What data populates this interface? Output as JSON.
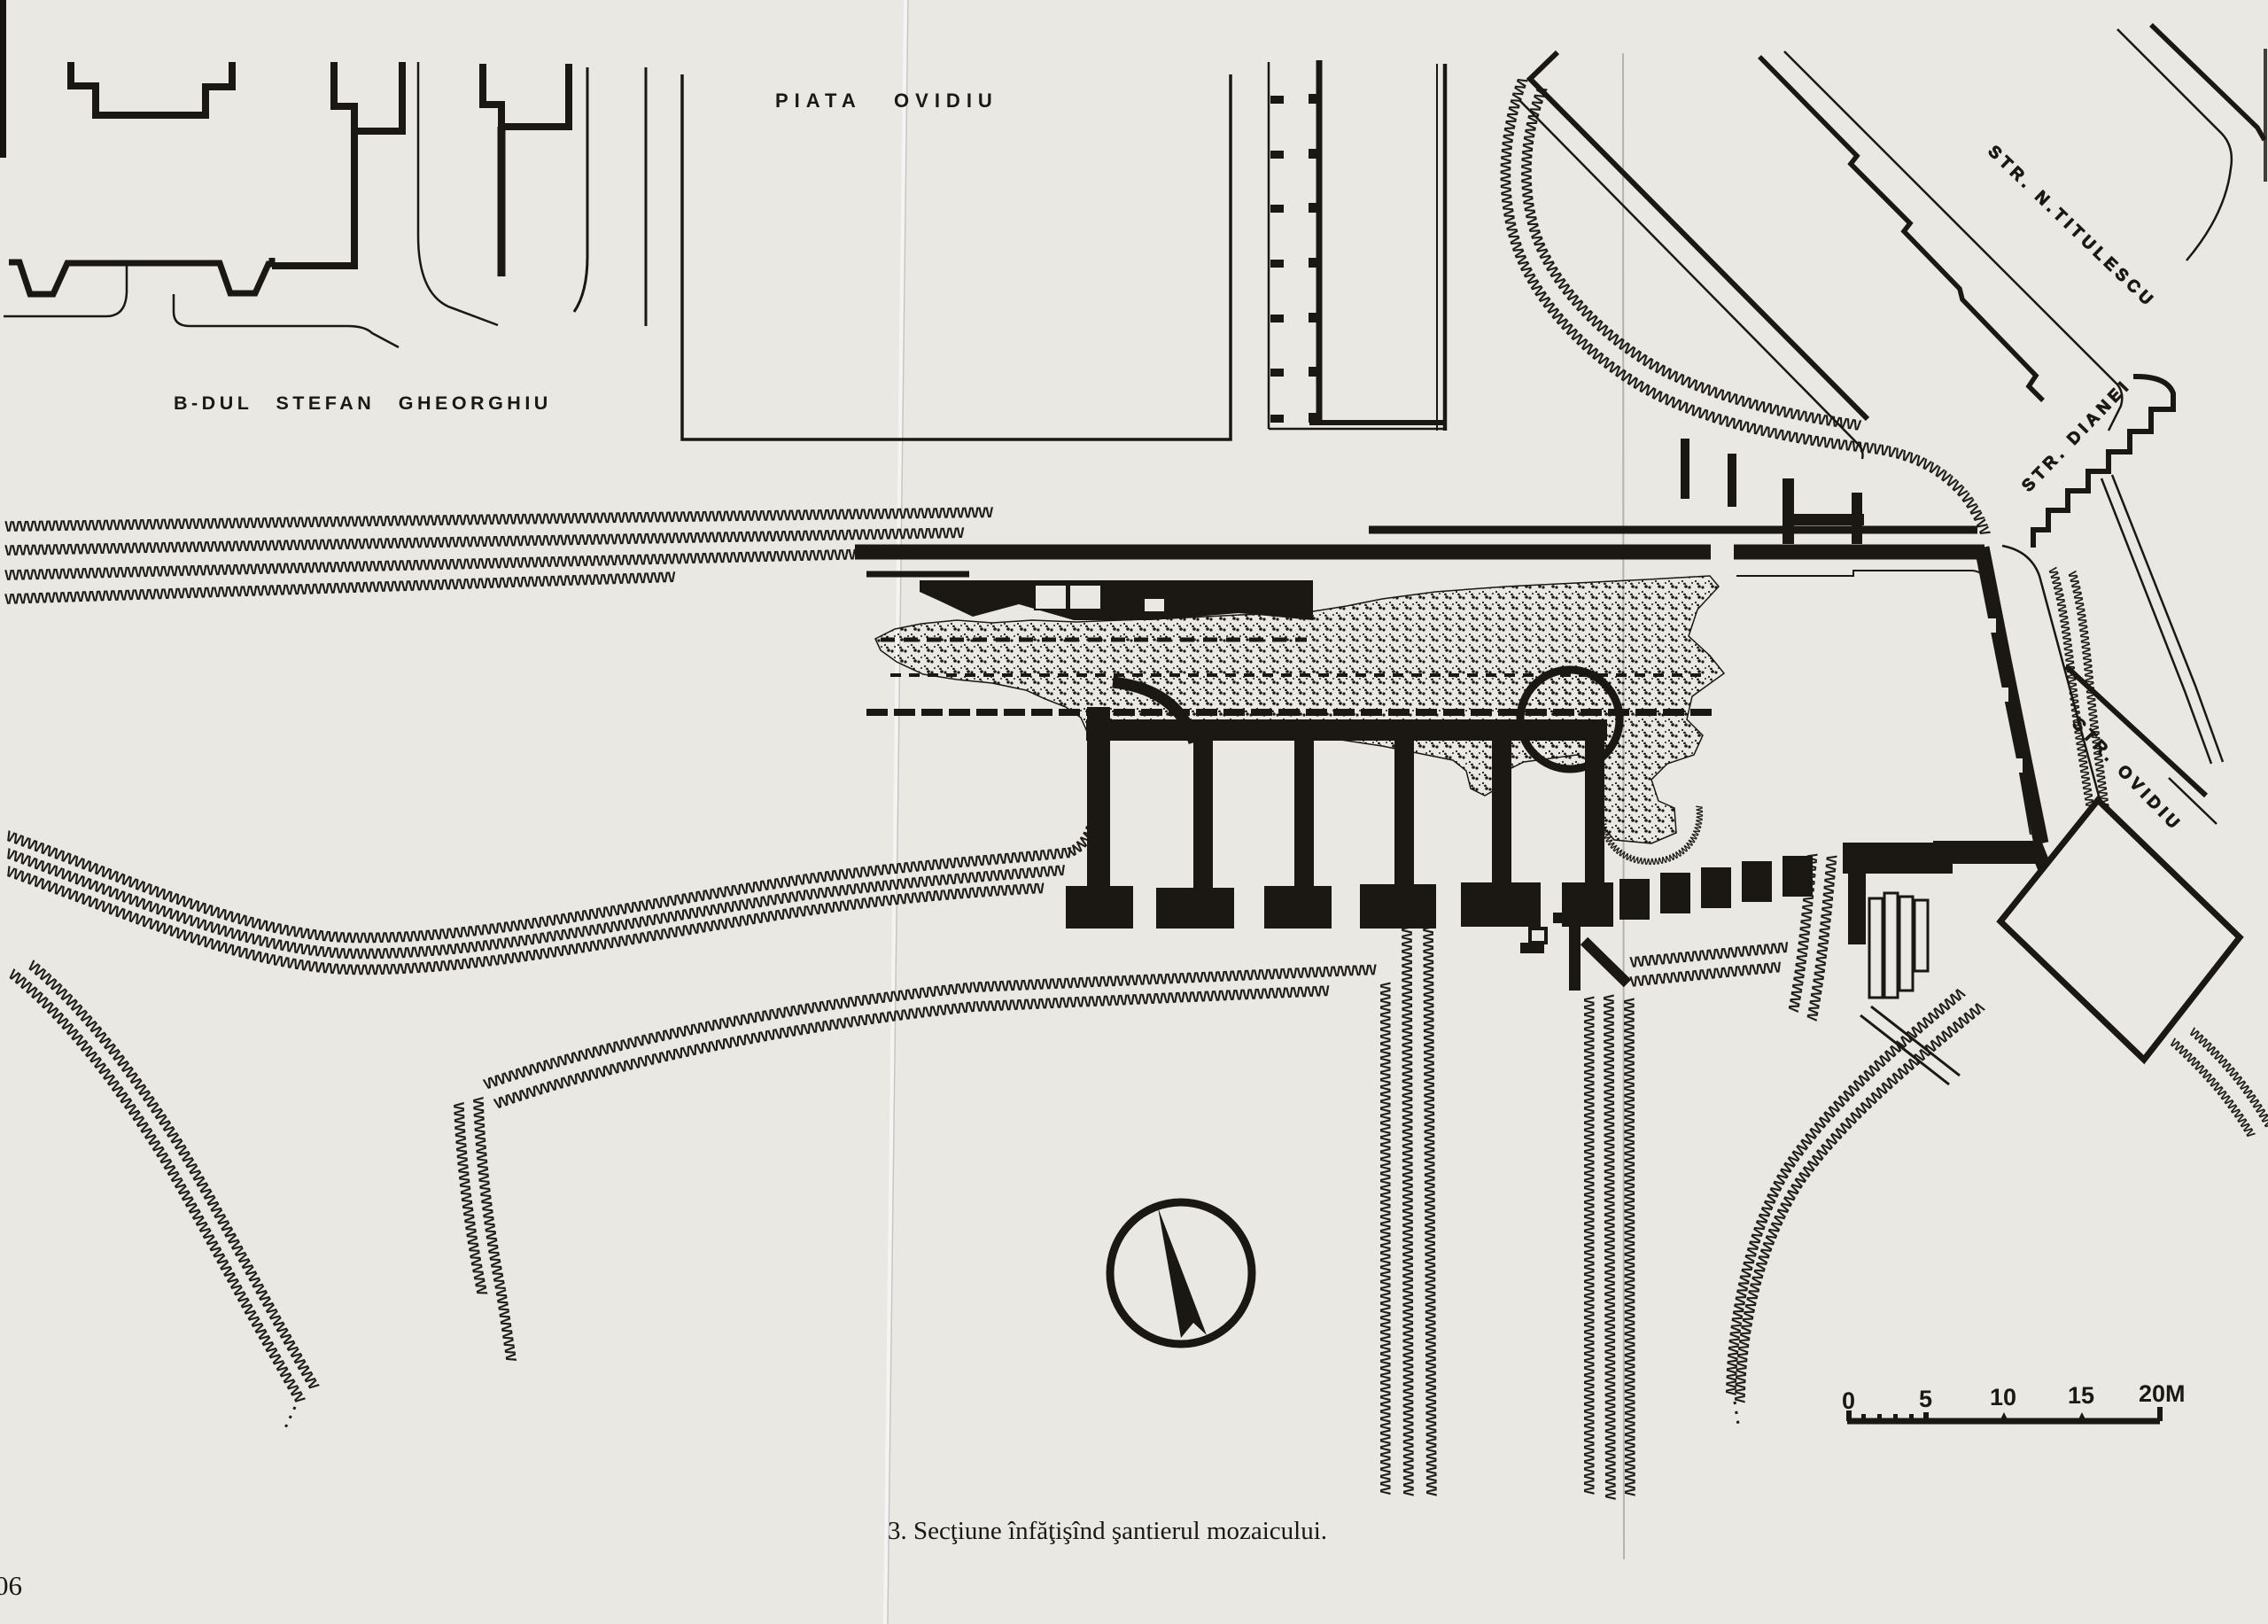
{
  "map": {
    "labels": {
      "square": "PIATA OVIDIU",
      "boulevard": "B-DUL STEFAN GHEORGHIU",
      "street_titulescu": "STR. N.TITULESCU",
      "street_dianei": "STR. DIANEI",
      "street_ovidiu": "STR. OVIDIU"
    },
    "scale_bar": {
      "labels": [
        "0",
        "5",
        "10",
        "15",
        "20M"
      ]
    },
    "compass": "north-arrow",
    "ink_color": "#1b1713",
    "paper_color": "#eae8e3"
  },
  "figure": {
    "caption": "3. Secţiune înfăţişînd şantierul mozaicului."
  },
  "page": {
    "number_fragment": "06"
  }
}
